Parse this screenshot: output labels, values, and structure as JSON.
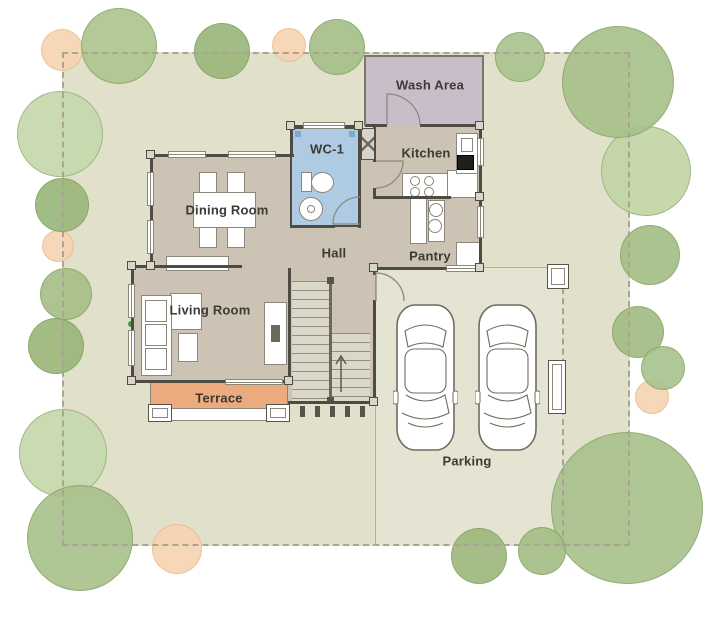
{
  "scene": {
    "kind": "residential floor plan with garden and parking"
  },
  "rooms": {
    "wash_area": "Wash Area",
    "wc": "WC-1",
    "kitchen": "Kitchen",
    "dining": "Dining Room",
    "hall": "Hall",
    "pantry": "Pantry",
    "living": "Living Room",
    "terrace": "Terrace"
  },
  "parking": {
    "label": "Parking",
    "car_count": 2
  },
  "colors": {
    "lawn": "#e1e0ca",
    "parking_slab": "#e5e4d2",
    "house_floor": "#ccc3b5",
    "wc_floor": "#aecbe3",
    "wash_floor": "#c9bdca",
    "terrace_floor": "#ecab7e",
    "wall": "#4e4b42",
    "tree_light": "#c6d9ad",
    "tree_medium": "#abc490",
    "tree_dark": "#9cb87d",
    "shrub_peach": "#f6d4b3",
    "label_text": "#3b3a33"
  },
  "garden": {
    "trees": [
      {
        "x": 62,
        "y": 50,
        "r": 21,
        "kind": "peach",
        "color": "#f6d4b3"
      },
      {
        "x": 289,
        "y": 45,
        "r": 17,
        "kind": "peach",
        "color": "#f6d4b3"
      },
      {
        "x": 58,
        "y": 246,
        "r": 16,
        "kind": "peach",
        "color": "#f6d4b3"
      },
      {
        "x": 177,
        "y": 549,
        "r": 25,
        "kind": "peach",
        "color": "#f6d4b3"
      },
      {
        "x": 652,
        "y": 397,
        "r": 17,
        "kind": "peach",
        "color": "#f6d4b3"
      },
      {
        "x": 60,
        "y": 134,
        "r": 43,
        "kind": "green",
        "color": "#c6d9ad"
      },
      {
        "x": 63,
        "y": 453,
        "r": 44,
        "kind": "green",
        "color": "#c6d9ad"
      },
      {
        "x": 646,
        "y": 171,
        "r": 45,
        "kind": "green",
        "color": "#c2d6a6"
      },
      {
        "x": 119,
        "y": 46,
        "r": 38,
        "kind": "green",
        "color": "#aec690"
      },
      {
        "x": 222,
        "y": 51,
        "r": 28,
        "kind": "green",
        "color": "#9cb87d"
      },
      {
        "x": 337,
        "y": 47,
        "r": 28,
        "kind": "green",
        "color": "#a6c089"
      },
      {
        "x": 520,
        "y": 57,
        "r": 25,
        "kind": "green",
        "color": "#abc490"
      },
      {
        "x": 618,
        "y": 82,
        "r": 56,
        "kind": "green",
        "color": "#a8c18c"
      },
      {
        "x": 650,
        "y": 255,
        "r": 30,
        "kind": "green",
        "color": "#a5bf87"
      },
      {
        "x": 638,
        "y": 332,
        "r": 26,
        "kind": "green",
        "color": "#a3bd84"
      },
      {
        "x": 663,
        "y": 368,
        "r": 22,
        "kind": "green",
        "color": "#aac490"
      },
      {
        "x": 627,
        "y": 508,
        "r": 76,
        "kind": "green",
        "color": "#aac28e"
      },
      {
        "x": 542,
        "y": 551,
        "r": 24,
        "kind": "green",
        "color": "#a5bf86"
      },
      {
        "x": 479,
        "y": 556,
        "r": 28,
        "kind": "green",
        "color": "#9fba7f"
      },
      {
        "x": 80,
        "y": 538,
        "r": 53,
        "kind": "green",
        "color": "#a9c28d"
      },
      {
        "x": 62,
        "y": 205,
        "r": 27,
        "kind": "green",
        "color": "#9cb87d"
      },
      {
        "x": 66,
        "y": 294,
        "r": 26,
        "kind": "green",
        "color": "#a7c089"
      },
      {
        "x": 56,
        "y": 346,
        "r": 28,
        "kind": "green",
        "color": "#9bb87b"
      }
    ]
  }
}
